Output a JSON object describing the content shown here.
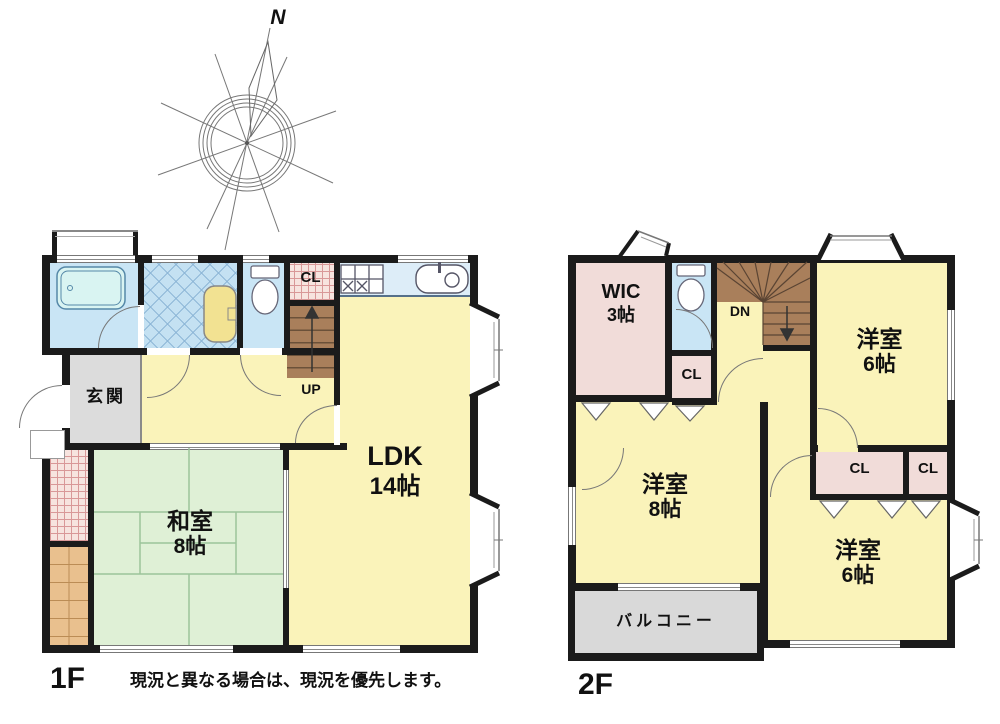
{
  "compass": {
    "north_label": "N"
  },
  "floor1": {
    "label": "1F",
    "stairs_label": "UP",
    "rooms": {
      "entrance": "玄関",
      "japanese_room_name": "和室",
      "japanese_room_size": "8帖",
      "ldk_name": "LDK",
      "ldk_size": "14帖",
      "closet": "CL"
    }
  },
  "floor2": {
    "label": "2F",
    "stairs_label": "DN",
    "rooms": {
      "wic_name": "WIC",
      "wic_size": "3帖",
      "hall_closet": "CL",
      "bedroom_north_name": "洋室",
      "bedroom_north_size": "6帖",
      "bedroom_west_name": "洋室",
      "bedroom_west_size": "8帖",
      "bedroom_south_name": "洋室",
      "bedroom_south_size": "6帖",
      "closet_a": "CL",
      "closet_b": "CL",
      "balcony": "バルコニー"
    }
  },
  "note": "現況と異なる場合は、現況を優先します。",
  "colors": {
    "wall": "#1b1b1b",
    "room_yellow": "#FAF3BA",
    "tatami_green": "#DFF0D6",
    "water_blue": "#C9E5F5",
    "tile_blue": "#C4E1F2",
    "tile_line": "#8FB8D8",
    "counter_blue": "#DDEDF8",
    "closet_pink": "#F1DCD9",
    "hatch_bg": "#F7E4DF",
    "hatch_line": "#D99898",
    "stair_brown": "#A97F5B",
    "entry_gray": "#DCDCDC",
    "balcony_gray": "#D9D9D9",
    "wood_tan": "#E9C08E",
    "fixture_teal": "#D9F4F2"
  }
}
